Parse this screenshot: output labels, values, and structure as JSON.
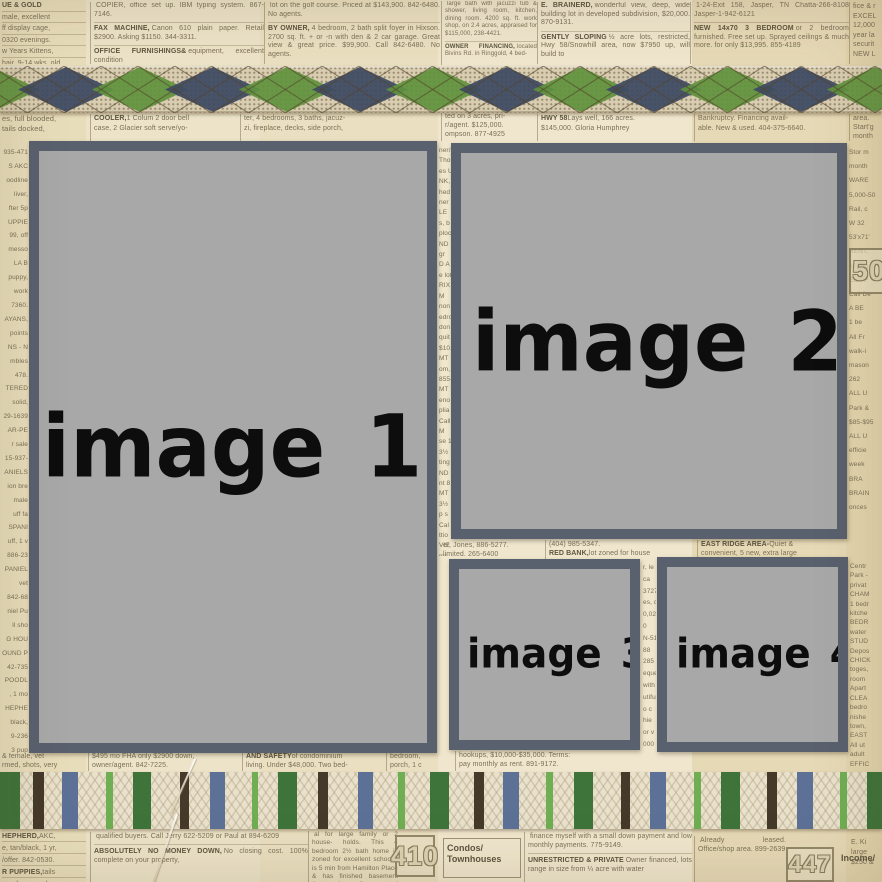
{
  "colors": {
    "frame_border": "#59606e",
    "frame_fill": "#a8a8a8",
    "label_ink": "#0d0d0d",
    "paper": "#eae0c4",
    "ink": "#7b7057",
    "ink_bold": "#5e553f",
    "argyle_base": "#d8cdb0",
    "argyle_navy": "#3d4962",
    "argyle_green": "#5f923d",
    "lattice": "#53422a",
    "ribbon_cream": "#e9e1cb",
    "stripe_dkgreen": "#3e7339",
    "stripe_brown": "#45392a",
    "stripe_blue": "#5d7096",
    "stripe_ltgreen": "#6fae52"
  },
  "placeholders": [
    {
      "label": "image 1"
    },
    {
      "label": "image 2"
    },
    {
      "label": "image 3"
    },
    {
      "label": "image 4"
    }
  ],
  "categories": {
    "c410": {
      "number": "410",
      "label_line1": "Condos/",
      "label_line2": "Townhouses"
    },
    "c447": {
      "number": "447",
      "label": "Income/"
    },
    "c50": {
      "number": "50"
    }
  },
  "argyle": {
    "diamonds": [
      {
        "x": -8,
        "c": "#5f923d"
      },
      {
        "x": 66,
        "c": "#3d4962"
      },
      {
        "x": 140,
        "c": "#5f923d"
      },
      {
        "x": 213,
        "c": "#3d4962"
      },
      {
        "x": 287,
        "c": "#5f923d"
      },
      {
        "x": 360,
        "c": "#3d4962"
      },
      {
        "x": 434,
        "c": "#5f923d"
      },
      {
        "x": 507,
        "c": "#3d4962"
      },
      {
        "x": 581,
        "c": "#5f923d"
      },
      {
        "x": 654,
        "c": "#3d4962"
      },
      {
        "x": 728,
        "c": "#5f923d"
      },
      {
        "x": 801,
        "c": "#3d4962"
      },
      {
        "x": 875,
        "c": "#5f923d"
      }
    ],
    "half_width": 48,
    "step": 36.85,
    "height": 47
  },
  "stripe_ribbon": {
    "stripes": [
      {
        "x": 0,
        "w": 20,
        "c": "#3e7339"
      },
      {
        "x": 33,
        "w": 11,
        "c": "#45392a"
      },
      {
        "x": 62,
        "w": 16,
        "c": "#5d7096"
      },
      {
        "x": 106,
        "w": 7,
        "c": "#6fae52"
      },
      {
        "x": 133,
        "w": 18,
        "c": "#3e7339"
      },
      {
        "x": 180,
        "w": 9,
        "c": "#45392a"
      },
      {
        "x": 210,
        "w": 15,
        "c": "#5d7096"
      },
      {
        "x": 252,
        "w": 6,
        "c": "#6fae52"
      },
      {
        "x": 278,
        "w": 19,
        "c": "#3e7339"
      },
      {
        "x": 318,
        "w": 10,
        "c": "#45392a"
      },
      {
        "x": 358,
        "w": 15,
        "c": "#5d7096"
      },
      {
        "x": 398,
        "w": 7,
        "c": "#6fae52"
      },
      {
        "x": 430,
        "w": 19,
        "c": "#3e7339"
      },
      {
        "x": 474,
        "w": 10,
        "c": "#45392a"
      },
      {
        "x": 503,
        "w": 16,
        "c": "#5d7096"
      },
      {
        "x": 546,
        "w": 7,
        "c": "#6fae52"
      },
      {
        "x": 574,
        "w": 19,
        "c": "#3e7339"
      },
      {
        "x": 621,
        "w": 9,
        "c": "#45392a"
      },
      {
        "x": 650,
        "w": 16,
        "c": "#5d7096"
      },
      {
        "x": 694,
        "w": 7,
        "c": "#6fae52"
      },
      {
        "x": 721,
        "w": 19,
        "c": "#3e7339"
      },
      {
        "x": 767,
        "w": 10,
        "c": "#45392a"
      },
      {
        "x": 797,
        "w": 16,
        "c": "#5d7096"
      },
      {
        "x": 840,
        "w": 7,
        "c": "#6fae52"
      },
      {
        "x": 867,
        "w": 15,
        "c": "#3e7339"
      }
    ]
  },
  "newspaper": {
    "top": {
      "a": [
        {
          "l": "UE & GOLD",
          "t": ""
        },
        {
          "t": "male, excellent"
        },
        {
          "t": "ff display cage,"
        },
        {
          "t": "0320 evenings."
        },
        {
          "t": "w Years Kittens,"
        },
        {
          "t": "hair, 9-14 wks. old"
        },
        {
          "t": "$40 credit at"
        }
      ],
      "b": [
        {
          "t": "COPIER, office set up. IBM typing system. 867-7146."
        },
        {
          "l": "FAX MACHINE,",
          "t": "Canon 610 plain paper. Retail $2900. Asking $1150. 344-3311."
        },
        {
          "l": "OFFICE FURNISHINGS&",
          "t": "equipment, excellent condition"
        }
      ],
      "c": [
        {
          "t": "lot on the golf course. Priced at $143,900. 842-6480. No agents."
        },
        {
          "l": "BY OWNER,",
          "t": "4 bedroom, 2 bath split foyer in Hixson. 2700 sq. ft. + or -n with den & 2 car garage. Great view & great price. $99,900. Call 842-6480. No agents."
        }
      ],
      "d": [
        {
          "t": "large bath with jacuzzi tub & shower, living room, kitchen, dining room. 4200 sq. ft. work shop, on 2.4 acres, appraised for $115,000, 238-4421."
        },
        {
          "l": "OWNER FINANCING,",
          "t": "located Bivins Rd. in Ringgold, 4 bed-"
        }
      ],
      "e": [
        {
          "l": "E. BRAINERD,",
          "t": "wonderful view, deep, wide building lot in developed subdivision, $20,000. 870-9131."
        },
        {
          "l": "GENTLY SLOPING",
          "t": "½ acre lots, restricted, Hwy 58/Snowhill area, now $7950 up, will build to"
        }
      ],
      "f": [
        {
          "t": "1-24-Exit 158, Jasper, TN Chatta-266-8108 Jasper-1-942-6121"
        },
        {
          "l": "NEW 14x70 3 BEDROOM",
          "t": "or 2 bedroom furnished. Free set up. Sprayed ceilings & much more. for only $13,995. 855-4189"
        }
      ],
      "g": [
        {
          "t": "fice & r"
        },
        {
          "t": "EXCEL"
        },
        {
          "t": "12,000"
        },
        {
          "t": "year la"
        },
        {
          "t": "securit"
        },
        {
          "t": "NEW L"
        }
      ]
    },
    "mid": {
      "a": [
        {
          "t": "es, full blooded,"
        },
        {
          "t": "tails docked,"
        }
      ],
      "b": [
        {
          "l": "COOLER,",
          "t": "1 Colum 2 door bell"
        },
        {
          "t": "case, 2 Glacier soft serve/yo-"
        }
      ],
      "c": [
        {
          "t": "ter, 4 bedrooms, 3 baths, jacuz-"
        },
        {
          "t": "zi, fireplace, decks, side porch,"
        }
      ],
      "d": [
        {
          "t": "ted on 3 acres, pri-"
        },
        {
          "t": "r/agent. $125,000."
        },
        {
          "t": "ompson. 877-4925"
        }
      ],
      "e": [
        {
          "l": "HWY 58",
          "t": "Lays well, 166 acres."
        },
        {
          "t": "$145,000. Gloria Humphrey"
        }
      ],
      "f": [
        {
          "t": "Bankruptcy. Financing avail-"
        },
        {
          "t": "able. New & used. 404-375-6640."
        }
      ],
      "g": [
        {
          "t": "area."
        },
        {
          "t": "Start'g"
        },
        {
          "t": "month"
        }
      ]
    },
    "left_strip": [
      {
        "t": "935-471"
      },
      {
        "t": "S AKC"
      },
      {
        "t": "oodline"
      },
      {
        "t": "liver,"
      },
      {
        "t": "fter 5p"
      },
      {
        "t": "UPPIE"
      },
      {
        "t": "99, off"
      },
      {
        "t": "messo"
      },
      {
        "t": "LA B"
      },
      {
        "t": "puppy,"
      },
      {
        "t": "work"
      },
      {
        "t": "7360."
      },
      {
        "t": "AYANS,"
      },
      {
        "t": "points"
      },
      {
        "t": "NS - N"
      },
      {
        "t": "mbles"
      },
      {
        "t": "478."
      },
      {
        "t": "TERED"
      },
      {
        "t": "solid,"
      },
      {
        "t": "29-1639"
      },
      {
        "t": "AR-PE"
      },
      {
        "t": "r sale"
      },
      {
        "t": "15-937-"
      },
      {
        "t": "ANIELS"
      },
      {
        "t": "ion bre"
      },
      {
        "t": "male"
      },
      {
        "t": "uff fa"
      },
      {
        "t": "SPANI"
      },
      {
        "t": "uff, 1 v"
      },
      {
        "t": "886-23"
      },
      {
        "t": "PANIEL"
      },
      {
        "t": "vet"
      },
      {
        "t": "842-68"
      },
      {
        "t": "niel Pu"
      },
      {
        "t": "ll sho"
      },
      {
        "t": "G HOU"
      },
      {
        "t": "OUND P"
      },
      {
        "t": "42-735"
      },
      {
        "t": "POODL"
      },
      {
        "t": ", 1 mo"
      },
      {
        "t": "HEPHE"
      },
      {
        "t": "black,"
      },
      {
        "t": "9-236"
      },
      {
        "t": "3 pup"
      }
    ],
    "mid_strip1": [
      {
        "t": "ner/oge"
      },
      {
        "t": "Thomp"
      },
      {
        "t": "es U"
      },
      {
        "t": "NK,"
      },
      {
        "t": "hed"
      },
      {
        "t": "ner"
      },
      {
        "t": "LE"
      },
      {
        "t": "s, b"
      },
      {
        "t": "ploce"
      },
      {
        "t": "ND"
      },
      {
        "t": "gr"
      },
      {
        "t": "D A"
      },
      {
        "t": "e lot"
      },
      {
        "t": "RIX"
      },
      {
        "t": "M"
      },
      {
        "t": "non"
      },
      {
        "t": "edro"
      },
      {
        "t": "don"
      },
      {
        "t": "quit"
      },
      {
        "t": "$10,"
      },
      {
        "t": "MT"
      },
      {
        "t": "om,"
      },
      {
        "t": "855-"
      },
      {
        "t": "MT"
      },
      {
        "t": "eno"
      },
      {
        "t": "plia"
      },
      {
        "t": "Call"
      },
      {
        "t": "M"
      },
      {
        "t": "se 1"
      },
      {
        "t": "3½"
      },
      {
        "t": "ting"
      },
      {
        "t": "ND"
      },
      {
        "t": "nt 8"
      },
      {
        "t": "MT"
      },
      {
        "t": "3½"
      },
      {
        "t": "p s"
      },
      {
        "t": "Cal"
      },
      {
        "t": "ttio"
      },
      {
        "t": "VIE"
      },
      {
        "t": "ms,"
      }
    ],
    "right_strip1": [
      {
        "t": "Stor m"
      },
      {
        "t": "month"
      },
      {
        "t": "WARE"
      },
      {
        "t": "5,000-50"
      },
      {
        "t": "Rail, c"
      },
      {
        "t": "W 32"
      },
      {
        "t": "53'x71'"
      },
      {
        "t": "RENT,"
      },
      {
        "t": "ceiling"
      },
      {
        "t": "East F"
      },
      {
        "t": "Call De"
      },
      {
        "t": "A BE"
      },
      {
        "t": "1 be"
      },
      {
        "t": "All Fr"
      },
      {
        "t": "walk-i"
      },
      {
        "t": "mason"
      },
      {
        "t": "262"
      },
      {
        "t": "ALL U"
      },
      {
        "t": "Park &"
      },
      {
        "t": "$85-$95"
      },
      {
        "t": "ALL U"
      },
      {
        "t": "efficie"
      },
      {
        "t": "week"
      },
      {
        "t": "BRA"
      },
      {
        "t": "BRAIN"
      },
      {
        "t": "onces"
      }
    ],
    "mid_strip2": [
      {
        "t": "r, le"
      },
      {
        "t": "ca"
      },
      {
        "t": "3727"
      },
      {
        "t": "es, c"
      },
      {
        "t": "0,020"
      },
      {
        "t": "0"
      },
      {
        "t": "N-51"
      },
      {
        "t": "88"
      },
      {
        "t": "285"
      },
      {
        "t": "eque"
      },
      {
        "t": "with"
      },
      {
        "t": "utiful"
      },
      {
        "t": "o c"
      },
      {
        "t": "hie"
      },
      {
        "t": "or v"
      },
      {
        "t": "000"
      }
    ],
    "right_strip2": [
      {
        "t": "Centr"
      },
      {
        "t": "Park -"
      },
      {
        "t": "privat"
      },
      {
        "t": "CHAM"
      },
      {
        "t": "1 bedr"
      },
      {
        "t": "kitche"
      },
      {
        "t": "BEDR"
      },
      {
        "t": "water"
      },
      {
        "t": "STUD"
      },
      {
        "t": "Depos"
      },
      {
        "t": "CHICK"
      },
      {
        "t": "toges,"
      },
      {
        "t": "room"
      },
      {
        "t": "Apart"
      },
      {
        "t": "CLEA"
      },
      {
        "t": "bedro"
      },
      {
        "t": "nishe"
      },
      {
        "t": "town,"
      },
      {
        "t": "EAST"
      },
      {
        "t": "All ut"
      },
      {
        "t": "adult"
      },
      {
        "t": "EFFIC"
      }
    ],
    "gap": {
      "a": [
        {
          "t": "er, Jones, 886-5277."
        },
        {
          "t": "limited. 265-6400"
        }
      ],
      "b": [
        {
          "t": "(404) 985-5347."
        },
        {
          "l": "RED BANK,",
          "t": "lot zoned for house"
        }
      ],
      "c": [
        {
          "l": "EAST RIDGE AREA-",
          "t": "Quiet &"
        },
        {
          "t": "convenient, 5 new, extra large"
        }
      ]
    },
    "below": {
      "a": [
        {
          "t": "& female, vet"
        },
        {
          "t": "rmed, shots, very"
        }
      ],
      "b": [
        {
          "t": "$495 mo FHA only $2900 down,"
        },
        {
          "t": "owner/agent. 842-7225."
        }
      ],
      "c": [
        {
          "l": "AND SAFETY",
          "t": "of condominium"
        },
        {
          "t": "living. Under $48,000. Two bed-"
        }
      ],
      "d": [
        {
          "t": "bedroom,"
        },
        {
          "t": "porch, 1 c"
        }
      ],
      "e": [
        {
          "t": "hookups, $10,000-$35,000. Terms:"
        },
        {
          "t": "pay monthly as rent. 891-9172."
        }
      ]
    },
    "bottom": {
      "a": [
        {
          "l": "HEPHERD,",
          "t": "AKC,"
        },
        {
          "t": "e, tan/black, 1 yr,"
        },
        {
          "t": "/offer. 842-0530."
        },
        {
          "l": "R PUPPIES,",
          "t": "tails"
        },
        {
          "t": "aned, wormed"
        }
      ],
      "b": [
        {
          "t": "qualified buyers. Call Jerry 622-5209 or Paul at 894-6209"
        },
        {
          "l": "ABSOLUTELY NO MONEY DOWN,",
          "t": "No closing cost. 100% complete on your property,"
        }
      ],
      "c": [
        {
          "t": "al for large family or 2 house- holds. This 4 bedroom 2½ bath home is zoned for excellent schools, is 5 min from Hamilton Place & has finished basement that can be easily converted to"
        }
      ],
      "d": [
        {
          "t": "finance myself with a small down payment and low monthly payments. 775-9149."
        },
        {
          "l": "UNRESTRICTED & PRIVATE",
          "t": "Owner financed, lots range in size from ¼ acre with water"
        }
      ],
      "e": [
        {
          "t": "Already leased. Office/shop area. 899-2639"
        }
      ],
      "f": [
        {
          "t": "E. Ki"
        },
        {
          "t": "large"
        },
        {
          "t": "$250 &"
        }
      ]
    }
  }
}
